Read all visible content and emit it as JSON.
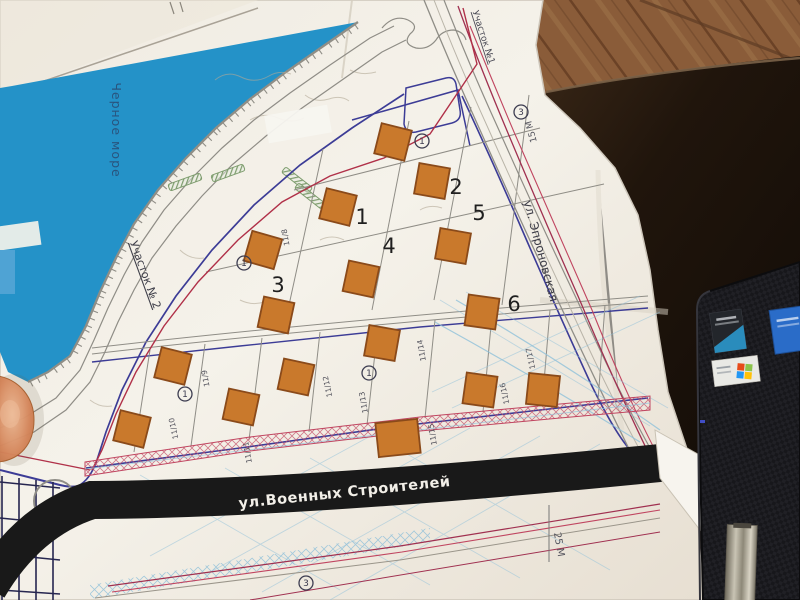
{
  "map": {
    "labels": {
      "sea": "Черное море",
      "site2": "Участок № 2",
      "site1": "Участок №1",
      "street_bottom": "ул.Военных Строителей",
      "street_right": "ул. Эпроновская",
      "scale_right": "15 М",
      "scale_bottom": "25 М"
    },
    "annotation_numbers": [
      {
        "text": "1",
        "x": 362,
        "y": 217
      },
      {
        "text": "2",
        "x": 456,
        "y": 187
      },
      {
        "text": "3",
        "x": 278,
        "y": 285
      },
      {
        "text": "4",
        "x": 389,
        "y": 246
      },
      {
        "text": "5",
        "x": 479,
        "y": 213
      },
      {
        "text": "6",
        "x": 514,
        "y": 304
      }
    ],
    "plot_numbers": [
      {
        "text": "11/8",
        "x": 288,
        "y": 237,
        "rot": -100
      },
      {
        "text": "11/9",
        "x": 208,
        "y": 378,
        "rot": -100
      },
      {
        "text": "11/10",
        "x": 176,
        "y": 428,
        "rot": -102
      },
      {
        "text": "11/11",
        "x": 250,
        "y": 452,
        "rot": -100
      },
      {
        "text": "11/12",
        "x": 330,
        "y": 386,
        "rot": -102
      },
      {
        "text": "11/13",
        "x": 366,
        "y": 402,
        "rot": -100
      },
      {
        "text": "11/14",
        "x": 424,
        "y": 350,
        "rot": -100
      },
      {
        "text": "11/15",
        "x": 435,
        "y": 434,
        "rot": -100
      },
      {
        "text": "11/16",
        "x": 507,
        "y": 393,
        "rot": -102
      },
      {
        "text": "11/17",
        "x": 533,
        "y": 358,
        "rot": -102
      }
    ],
    "circle_markers": [
      {
        "text": "1",
        "x": 422,
        "y": 141
      },
      {
        "text": "3",
        "x": 521,
        "y": 112
      },
      {
        "text": "1",
        "x": 244,
        "y": 263
      },
      {
        "text": "1",
        "x": 185,
        "y": 394
      },
      {
        "text": "1",
        "x": 369,
        "y": 373
      },
      {
        "text": "3",
        "x": 306,
        "y": 583
      }
    ],
    "buildings": [
      {
        "x": 393,
        "y": 142,
        "rot": 14
      },
      {
        "x": 432,
        "y": 181,
        "rot": 10
      },
      {
        "x": 338,
        "y": 207,
        "rot": 14
      },
      {
        "x": 453,
        "y": 246,
        "rot": 10
      },
      {
        "x": 361,
        "y": 279,
        "rot": 12
      },
      {
        "x": 263,
        "y": 250,
        "rot": 16
      },
      {
        "x": 276,
        "y": 315,
        "rot": 12
      },
      {
        "x": 482,
        "y": 312,
        "rot": 8
      },
      {
        "x": 173,
        "y": 366,
        "rot": 14
      },
      {
        "x": 296,
        "y": 377,
        "rot": 12
      },
      {
        "x": 382,
        "y": 343,
        "rot": 10
      },
      {
        "x": 241,
        "y": 407,
        "rot": 12
      },
      {
        "x": 132,
        "y": 429,
        "rot": 14
      },
      {
        "x": 398,
        "y": 438,
        "rot": -6,
        "w": 42,
        "h": 34
      },
      {
        "x": 480,
        "y": 390,
        "rot": 8
      },
      {
        "x": 543,
        "y": 390,
        "rot": 6
      }
    ],
    "colors": {
      "sea": "#2492c8",
      "building": "#c9792c",
      "building_border": "#8a4a1a",
      "boundary_navy": "#3c3c96",
      "line_gray": "#8f8d86",
      "utility_maroon": "#a03050",
      "utility_crimson": "#c04560",
      "water_blue": "#8fc0da",
      "green": "#7d9c6d",
      "road_black": "#191919",
      "street_text": "#f2efe8",
      "annotation": "#1f1f1f"
    }
  }
}
